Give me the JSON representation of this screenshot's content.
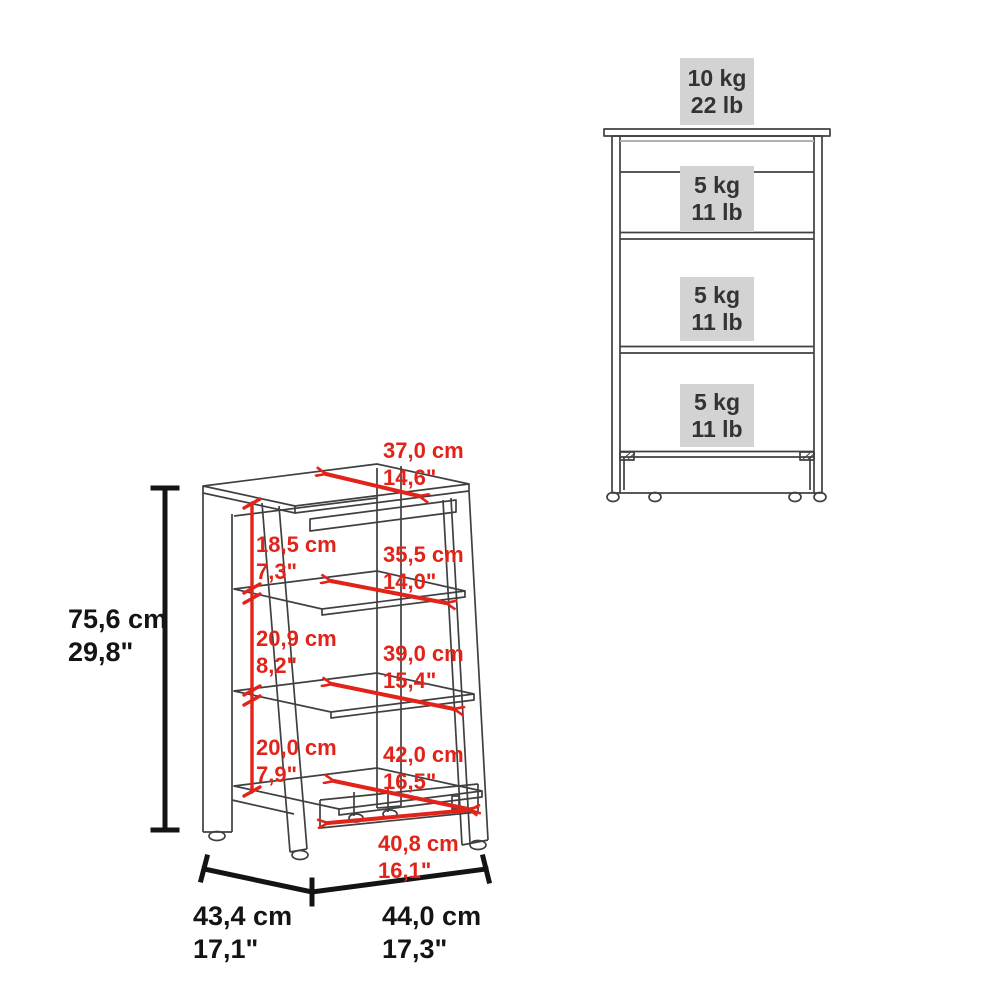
{
  "drawing_3d": {
    "height_label": {
      "cm": "75,6 cm",
      "in": "29,8\""
    },
    "depth_label": {
      "cm": "43,4 cm",
      "in": "17,1\""
    },
    "width_label": {
      "cm": "44,0 cm",
      "in": "17,3\""
    },
    "dims_red": [
      {
        "id": "top-depth",
        "cm": "37,0 cm",
        "in": "14,6\""
      },
      {
        "id": "compartment-1",
        "cm": "18,5 cm",
        "in": "7,3\""
      },
      {
        "id": "shelf-1-depth",
        "cm": "35,5 cm",
        "in": "14,0\""
      },
      {
        "id": "compartment-2",
        "cm": "20,9 cm",
        "in": "8,2\""
      },
      {
        "id": "shelf-2-depth",
        "cm": "39,0 cm",
        "in": "15,4\""
      },
      {
        "id": "compartment-3",
        "cm": "20,0 cm",
        "in": "7,9\""
      },
      {
        "id": "shelf-3-depth",
        "cm": "42,0 cm",
        "in": "16,5\""
      },
      {
        "id": "bottom-width",
        "cm": "40,8 cm",
        "in": "16,1\""
      }
    ]
  },
  "drawing_front": {
    "capacities": [
      {
        "kg": "10 kg",
        "lb": "22 lb"
      },
      {
        "kg": "5 kg",
        "lb": "11 lb"
      },
      {
        "kg": "5 kg",
        "lb": "11 lb"
      },
      {
        "kg": "5 kg",
        "lb": "11 lb"
      }
    ]
  },
  "colors": {
    "dimension_red": "#e2231a",
    "outline": "#404040",
    "dimension_black": "#141414",
    "capacity_box": "#d3d3d3"
  }
}
